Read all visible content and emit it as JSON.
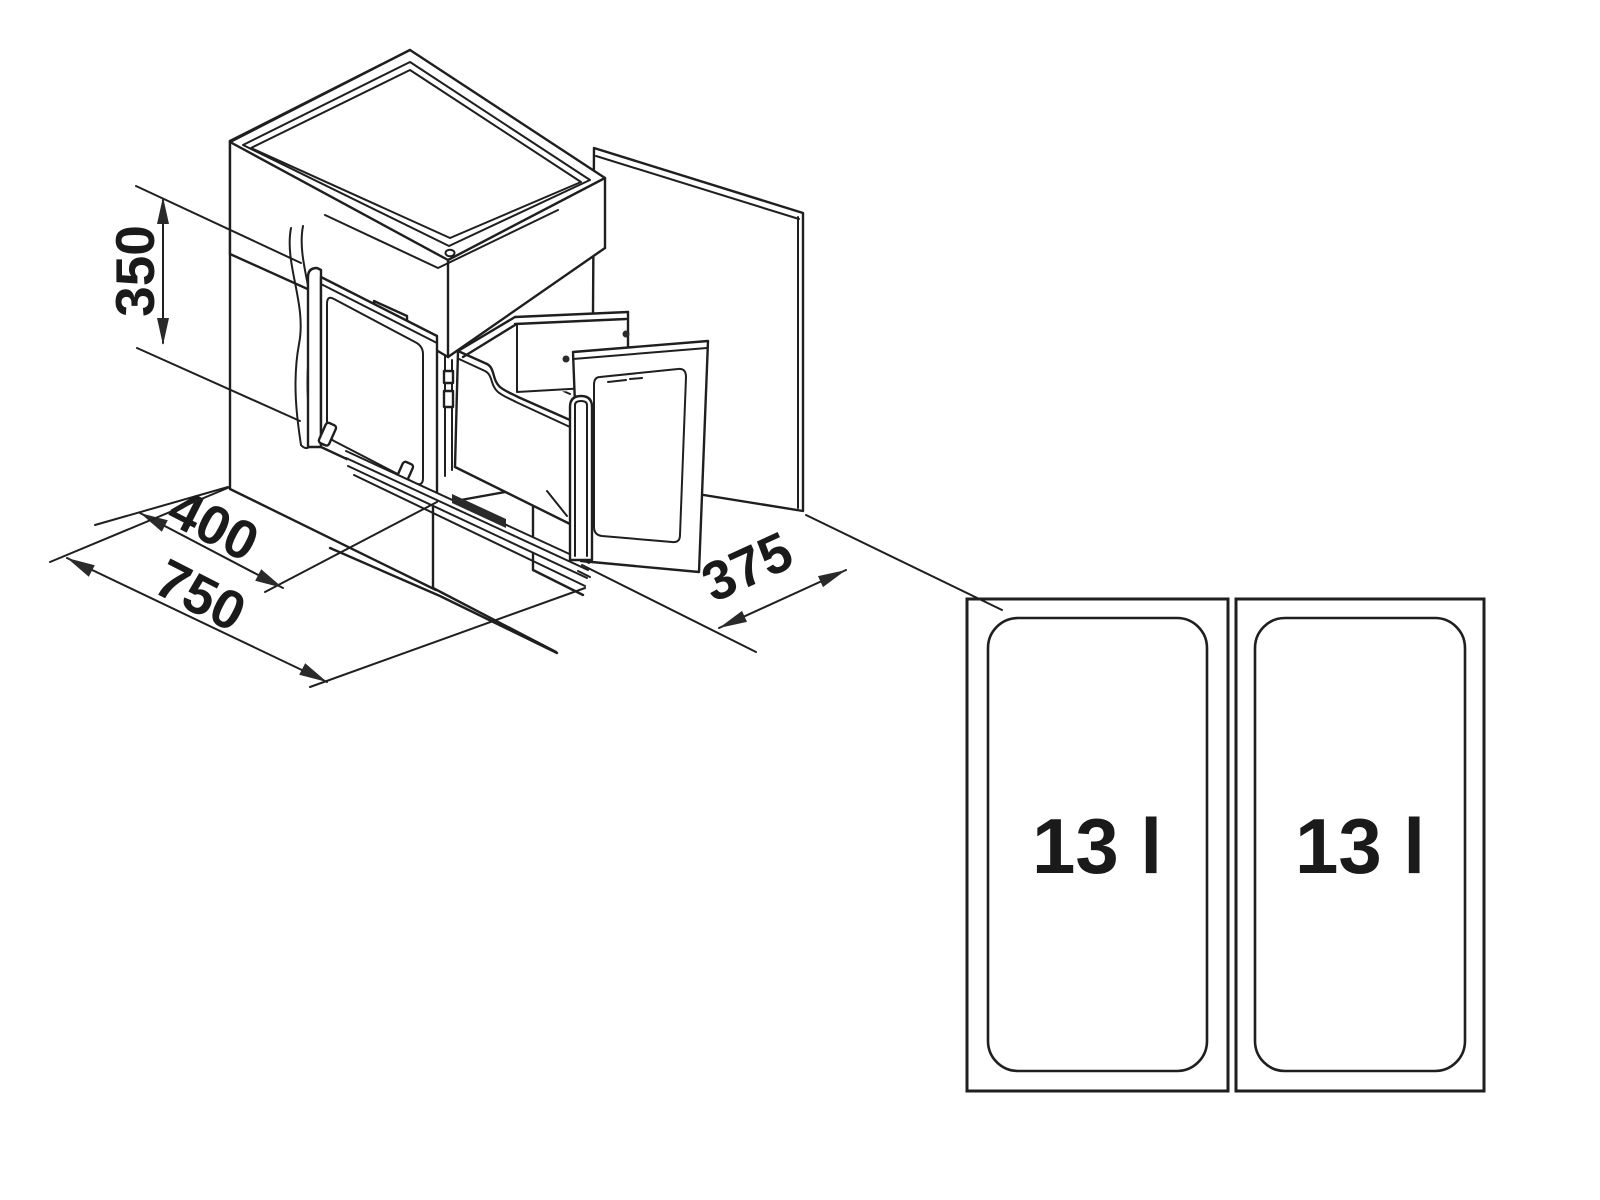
{
  "diagram": {
    "title_hidden": "",
    "colors": {
      "line": "#1f1f1f",
      "background": "#ffffff"
    },
    "dimensions": {
      "height": "350",
      "pullout_depth": "400",
      "cabinet_width": "750",
      "door_width": "375"
    },
    "top_view": {
      "bins": [
        {
          "label": "13 l"
        },
        {
          "label": "13 l"
        }
      ]
    }
  }
}
